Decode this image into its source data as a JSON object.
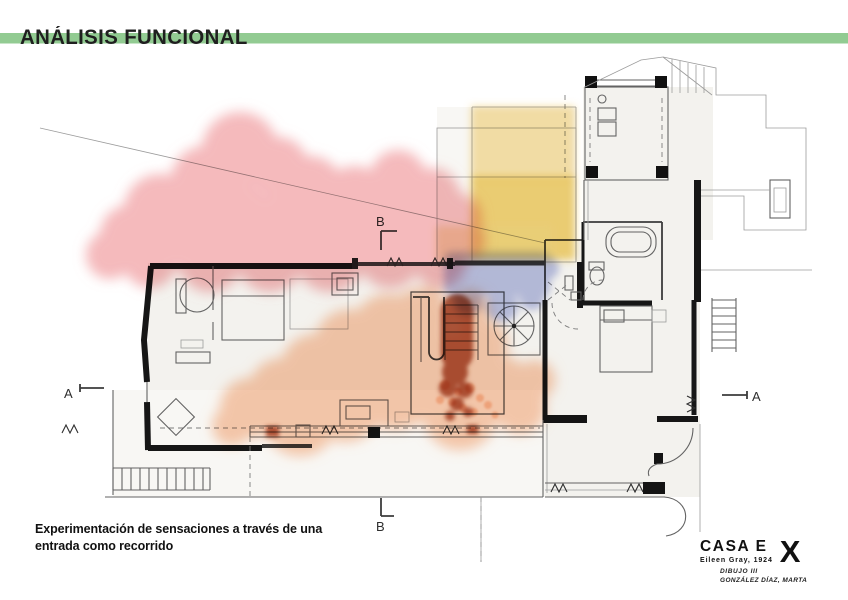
{
  "header": {
    "title": "ANÁLISIS FUNCIONAL"
  },
  "caption": {
    "line1": "Experimentación de sensaciones a través de una",
    "line2": "entrada como recorrido"
  },
  "project": {
    "name": "CASA E",
    "architect": "Eileen Gray, 1924",
    "course": "DIBUJO III",
    "author": "GONZÁLEZ DÍAZ, MARTA",
    "logo": "X"
  },
  "plan": {
    "markers": {
      "section_a_left": "A",
      "section_a_right": "A",
      "section_b_top": "B",
      "section_b_bottom": "B"
    }
  },
  "colors": {
    "title_bar_green": "#92cb92",
    "zone_red": "#ee8b8f",
    "zone_yellow_light": "#f2cd68",
    "zone_yellow": "#ecc243",
    "zone_yellow_wash": "#f0d780",
    "zone_blue": "#8e99d6",
    "zone_orange": "#f49a62",
    "zone_dark_red": "#a23c1e"
  }
}
